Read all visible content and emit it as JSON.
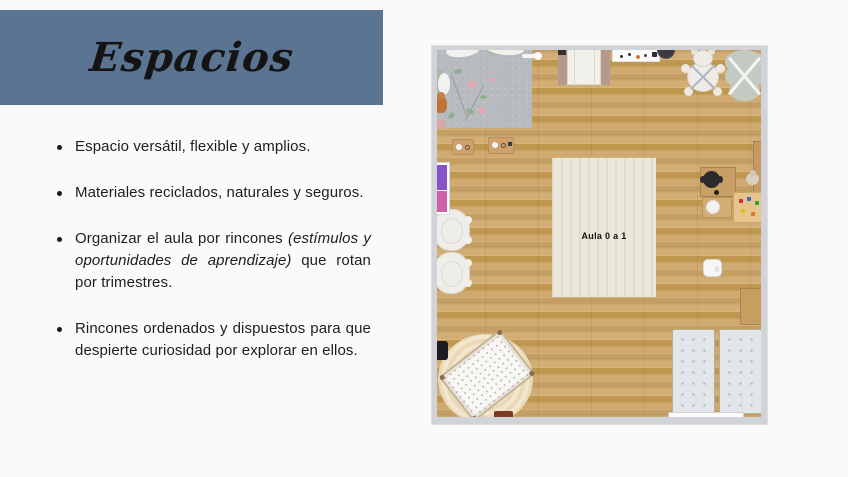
{
  "slide": {
    "title": "Espacios",
    "accent_color": "#5b7492",
    "background_color": "#fafafa",
    "text_color": "#1e1e1e"
  },
  "bullets": {
    "b1": "Espacio versátil, flexible y amplios.",
    "b2": "Materiales reciclados, naturales y seguros.",
    "b3_pre": "Organizar el aula por rincones ",
    "b3_italic": "(estímulos y oportunidades de aprendizaje)",
    "b3_post": " que rotan por trimestres.",
    "b4": "Rincones ordenados y dispuestos para que despierte curiosidad por explorar en ellos."
  },
  "floorplan": {
    "room_label": "Aula 0 a 1",
    "floor_color": "#caa56c",
    "wall_color": "#d2d3d8",
    "furniture": [
      "gray-play-rug",
      "leaf-garland",
      "pillows",
      "rattle-toy",
      "teddy-bear",
      "activity-trays",
      "purple-pink-wall-shelf",
      "round-armchairs",
      "entry-door",
      "wall-shelf-with-toys",
      "dark-floor-cushion",
      "baby-gym-bear-mat",
      "baby-gym-flower-mat",
      "center-rug",
      "teacher-desk",
      "office-chair",
      "side-table",
      "toy-table",
      "right-wall-cabinet",
      "potty",
      "nap-mats",
      "mat-shelf",
      "round-rug",
      "crib",
      "black-lamp",
      "wooden-tray"
    ]
  }
}
